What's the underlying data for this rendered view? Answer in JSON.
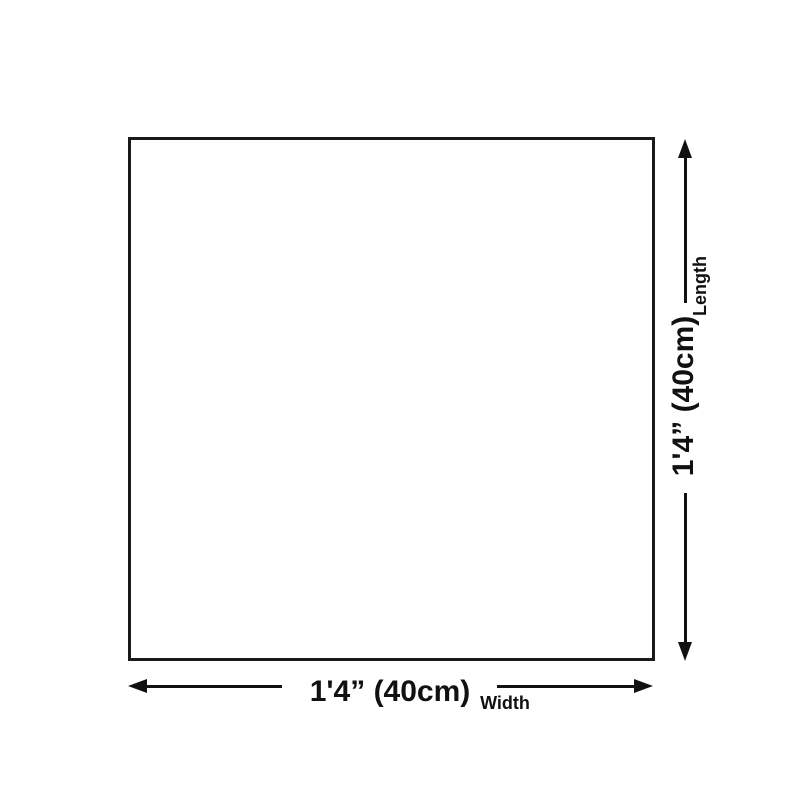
{
  "diagram": {
    "shape": "square",
    "width": {
      "dimension": "1'4” (40cm)",
      "axis_label": "Width"
    },
    "length": {
      "dimension": "1'4” (40cm)",
      "axis_label": "Length"
    }
  },
  "colors": {
    "outline": "#1a1a1a",
    "arrow": "#111111",
    "text": "#111111",
    "background": "#ffffff"
  }
}
